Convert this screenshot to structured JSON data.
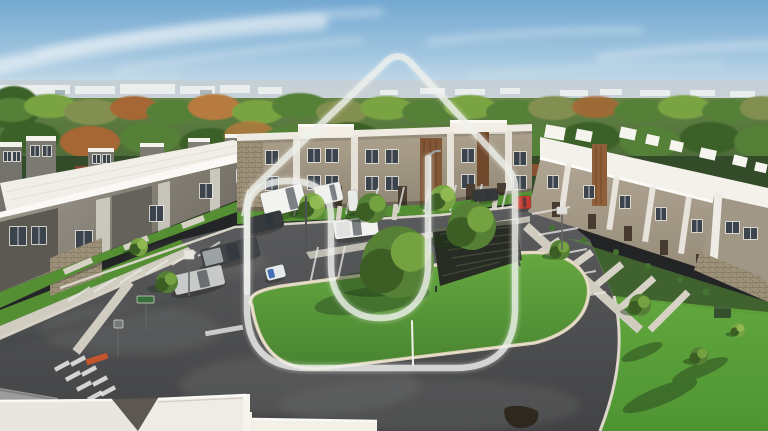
{
  "meta": {
    "description": "Aerial drone photo of a new two-story townhome community with white flat roofs, a central parking lot, fresh asphalt roads, a grass island with oak trees, and a translucent house-shaped U logo watermark overlaid in the center",
    "width": 768,
    "height": 431
  },
  "palette": {
    "sky-top": "#6ea6d2",
    "sky-mid": "#9ec5e0",
    "sky-low": "#cadfec",
    "sky-horizon": "#e4eef3",
    "haze": "#c3ced3",
    "distant-bldg": "#edf1f1",
    "tree-dark": "#355c22",
    "tree-mid": "#4f7c30",
    "tree-light": "#74a23e",
    "tree-olive": "#7e8c4c",
    "tree-rust": "#a4622e",
    "tree-rust2": "#b5773a",
    "rust-wall": "#83422a",
    "roof-white": "#f0efe9",
    "roof-bright": "#fafaf7",
    "wall-gray": "#8f8b80",
    "wall-dark": "#55544e",
    "wall-taupe": "#a89d89",
    "trim-white": "#eceae2",
    "brown-panel": "#8a5a33",
    "stone": "#978b73",
    "window-dark": "#333d48",
    "asphalt": "#46484b",
    "asphalt-light": "#6a6c6d",
    "asphalt-dark": "#323436",
    "paint-line": "#e9eae8",
    "curb": "#d8d4c8",
    "curb-tan": "#d9cfb6",
    "sidewalk": "#cfccc0",
    "grass": "#55972f",
    "grass-dark": "#3f7526",
    "grass-shadow": "#26481b",
    "red-curb": "#c05028",
    "watermark": "#edf1ed"
  },
  "watermark": {
    "name": "house-u-logo",
    "outer_path": "M247 308 L247 206 Q247 195 254 188 L386 62 Q398 51 410 62 L508 169 Q515 177 515 188 L515 308 Q515 368 455 368 L307 368 Q247 368 247 308 Z",
    "inner_path": "M247 292 L247 216 C247 193 260 181 289 181 C318 181 331 194 331 217 L331 265 C331 297 350 318 380 318 C410 318 428 297 428 265 L428 158",
    "color": "#edf1ed",
    "opacity": 0.78,
    "stroke_width": 6.5
  },
  "vehicles": [
    {
      "name": "white-cargo-van",
      "x": 262,
      "y": 188,
      "w": 43,
      "h": 25,
      "rot": -14,
      "color": "#f3f4f3",
      "ws": 0.6,
      "accent": null
    },
    {
      "name": "white-utility-truck",
      "x": 315,
      "y": 184,
      "w": 27,
      "h": 19,
      "rot": -12,
      "color": "#eef0ef",
      "ws": 0.58,
      "accent": null
    },
    {
      "name": "porta-potty",
      "x": 348,
      "y": 190,
      "w": 10,
      "h": 21,
      "rot": -4,
      "color": "#e8ebea",
      "ws": null,
      "accent": null
    },
    {
      "name": "dark-sedan",
      "x": 248,
      "y": 214,
      "w": 35,
      "h": 16,
      "rot": -14,
      "color": "#2f3337",
      "ws": 0.52,
      "accent": null
    },
    {
      "name": "dark-pickup-truck",
      "x": 201,
      "y": 243,
      "w": 58,
      "h": 19,
      "rot": -14,
      "color": "#3a3e42",
      "ws": 0.45,
      "accent": "#9aa0a4"
    },
    {
      "name": "silver-sedan",
      "x": 173,
      "y": 270,
      "w": 51,
      "h": 20,
      "rot": -13,
      "color": "#c6c8c9",
      "ws": 0.5,
      "accent": null
    },
    {
      "name": "white-pickup-truck",
      "x": 334,
      "y": 218,
      "w": 44,
      "h": 19,
      "rot": -7,
      "color": "#f2f3f2",
      "ws": 0.42,
      "accent": "#e0e2e1"
    },
    {
      "name": "dark-suv",
      "x": 473,
      "y": 189,
      "w": 25,
      "h": 12,
      "rot": -4,
      "color": "#2e3236",
      "ws": 0.52,
      "accent": null
    },
    {
      "name": "red-hatchback",
      "x": 514,
      "y": 196,
      "w": 17,
      "h": 13,
      "rot": -3,
      "color": "#c0362b",
      "ws": 0.52,
      "accent": null
    },
    {
      "name": "utility-cart",
      "x": 266,
      "y": 266,
      "w": 19,
      "h": 13,
      "rot": -14,
      "color": "#e7ebee",
      "ws": null,
      "accent": "#3f6ab5"
    }
  ],
  "trees": [
    {
      "name": "island-oak-large",
      "x": 398,
      "y": 262,
      "r": 36,
      "tone": "mid"
    },
    {
      "name": "island-oak-small",
      "x": 472,
      "y": 226,
      "r": 24,
      "tone": "mid"
    },
    {
      "name": "front-tree-1",
      "x": 312,
      "y": 206,
      "r": 13,
      "tone": "light"
    },
    {
      "name": "front-tree-2",
      "x": 372,
      "y": 208,
      "r": 15,
      "tone": "mid"
    },
    {
      "name": "front-tree-3",
      "x": 443,
      "y": 198,
      "r": 13,
      "tone": "light"
    },
    {
      "name": "left-walk-tree",
      "x": 167,
      "y": 282,
      "r": 11,
      "tone": "mid"
    },
    {
      "name": "left-walk-tree-2",
      "x": 139,
      "y": 247,
      "r": 9,
      "tone": "light"
    },
    {
      "name": "right-row-tree",
      "x": 560,
      "y": 250,
      "r": 10,
      "tone": "mid"
    },
    {
      "name": "lawn-tree-1",
      "x": 640,
      "y": 305,
      "r": 11,
      "tone": "mid"
    },
    {
      "name": "lawn-tree-2",
      "x": 699,
      "y": 356,
      "r": 9,
      "tone": "mid"
    },
    {
      "name": "lawn-tree-3",
      "x": 738,
      "y": 330,
      "r": 7,
      "tone": "light"
    }
  ],
  "parking_lines": [
    {
      "x1": 248,
      "y1": 190,
      "x2": 242,
      "y2": 216
    },
    {
      "x1": 274,
      "y1": 190,
      "x2": 268,
      "y2": 216
    },
    {
      "x1": 300,
      "y1": 190,
      "x2": 294,
      "y2": 216
    },
    {
      "x1": 326,
      "y1": 189,
      "x2": 320,
      "y2": 215
    },
    {
      "x1": 352,
      "y1": 188,
      "x2": 346,
      "y2": 214
    },
    {
      "x1": 378,
      "y1": 188,
      "x2": 372,
      "y2": 214
    },
    {
      "x1": 404,
      "y1": 187,
      "x2": 398,
      "y2": 213
    },
    {
      "x1": 430,
      "y1": 186,
      "x2": 424,
      "y2": 212
    },
    {
      "x1": 456,
      "y1": 185,
      "x2": 450,
      "y2": 211
    },
    {
      "x1": 482,
      "y1": 184,
      "x2": 476,
      "y2": 210
    },
    {
      "x1": 508,
      "y1": 183,
      "x2": 502,
      "y2": 209
    },
    {
      "x1": 318,
      "y1": 247,
      "x2": 309,
      "y2": 289
    },
    {
      "x1": 345,
      "y1": 246,
      "x2": 336,
      "y2": 288
    },
    {
      "x1": 372,
      "y1": 245,
      "x2": 363,
      "y2": 287
    },
    {
      "x1": 399,
      "y1": 244,
      "x2": 390,
      "y2": 286
    },
    {
      "x1": 426,
      "y1": 243,
      "x2": 417,
      "y2": 285
    },
    {
      "x1": 453,
      "y1": 242,
      "x2": 444,
      "y2": 284
    },
    {
      "x1": 480,
      "y1": 241,
      "x2": 471,
      "y2": 283
    },
    {
      "x1": 507,
      "y1": 240,
      "x2": 498,
      "y2": 282
    },
    {
      "x1": 68,
      "y1": 301,
      "x2": 90,
      "y2": 287
    },
    {
      "x1": 94,
      "y1": 292,
      "x2": 116,
      "y2": 278
    },
    {
      "x1": 120,
      "y1": 283,
      "x2": 142,
      "y2": 269
    },
    {
      "x1": 146,
      "y1": 274,
      "x2": 168,
      "y2": 260
    },
    {
      "x1": 172,
      "y1": 265,
      "x2": 194,
      "y2": 251
    },
    {
      "x1": 198,
      "y1": 256,
      "x2": 220,
      "y2": 242
    },
    {
      "x1": 532,
      "y1": 214,
      "x2": 570,
      "y2": 207
    },
    {
      "x1": 538,
      "y1": 235,
      "x2": 578,
      "y2": 228
    },
    {
      "x1": 545,
      "y1": 257,
      "x2": 587,
      "y2": 249
    },
    {
      "x1": 553,
      "y1": 279,
      "x2": 596,
      "y2": 271
    },
    {
      "x1": 562,
      "y1": 300,
      "x2": 606,
      "y2": 292
    }
  ],
  "crosswalk_bars": [
    {
      "x": 62,
      "y": 366
    },
    {
      "x": 73,
      "y": 376
    },
    {
      "x": 84,
      "y": 386
    },
    {
      "x": 95,
      "y": 396
    },
    {
      "x": 78,
      "y": 361
    },
    {
      "x": 89,
      "y": 371
    },
    {
      "x": 100,
      "y": 381
    },
    {
      "x": 108,
      "y": 391
    }
  ],
  "poles": [
    {
      "name": "street-light-pole",
      "x1": 430,
      "y1": 154,
      "x2": 430,
      "y2": 253,
      "color": "#9aa0a3",
      "w": 2.5,
      "arm": "M430 157 Q432 150 440 151"
    },
    {
      "name": "parking-lot-pole",
      "x1": 306,
      "y1": 197,
      "x2": 306,
      "y2": 251,
      "color": "#4a4e50",
      "w": 2,
      "arm": null
    },
    {
      "name": "island-marker-post",
      "x1": 412,
      "y1": 321,
      "x2": 413,
      "y2": 365,
      "color": "#f2f2ee",
      "w": 2,
      "arm": null
    }
  ],
  "signs": [
    {
      "name": "street-name-sign",
      "px": 146,
      "py1": 302,
      "py2": 330,
      "sx": 137,
      "sy": 296,
      "sw": 17,
      "sh": 7,
      "fill": "#2e6b34"
    },
    {
      "name": "stop-sign-back",
      "px": 118,
      "py1": 327,
      "py2": 356,
      "sx": 114,
      "sy": 320,
      "sw": 9,
      "sh": 8,
      "fill": "#707476"
    },
    {
      "name": "parking-sign",
      "px": 189,
      "py1": 258,
      "py2": 296,
      "sx": 184,
      "sy": 250,
      "sw": 10,
      "sh": 9,
      "fill": "#e8e6e2"
    },
    {
      "name": "road-sign-right",
      "px": 562,
      "py1": 214,
      "py2": 250,
      "sx": 557,
      "sy": 207,
      "sw": 10,
      "sh": 7,
      "fill": "#dfe1e0"
    }
  ]
}
